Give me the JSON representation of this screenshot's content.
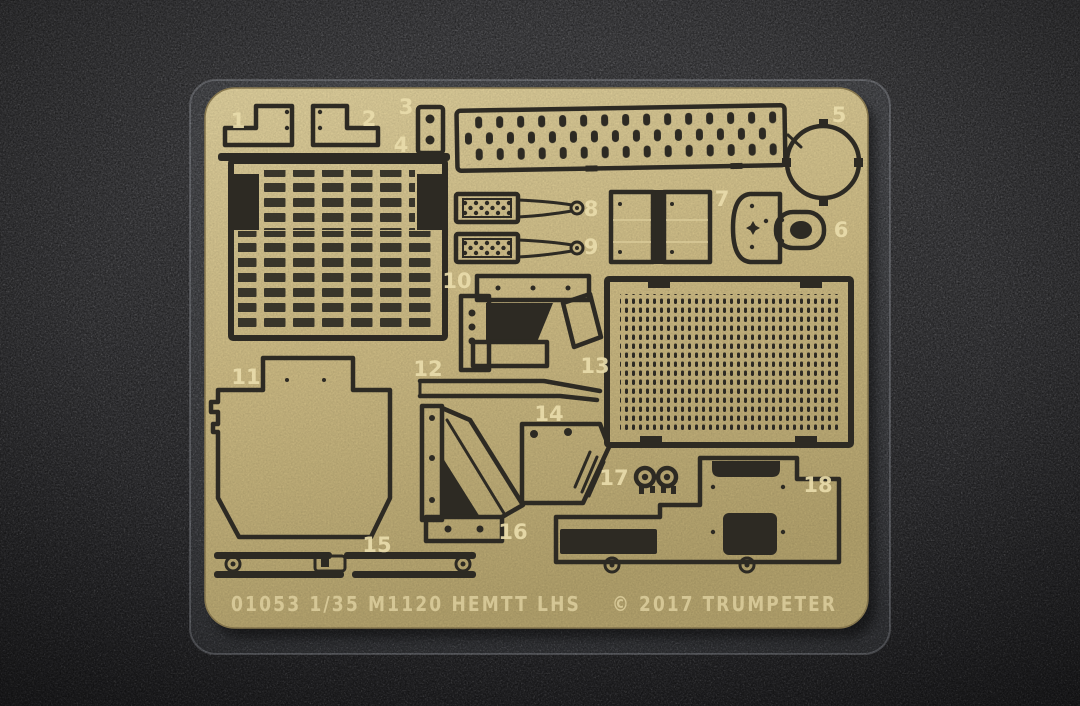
{
  "scene": {
    "subject": "photo-etched brass detail fret on dark carpet",
    "colors": {
      "carpet_base": "#3f3f42",
      "carpet_light": "#4b4b4e",
      "carpet_dark": "#29292c",
      "sleeve_edge": "#c9ced8",
      "brass": "#cbb983",
      "brass_light": "#dccd9b",
      "brass_dark": "#b2a16c",
      "etch_dark": "#2d2a23",
      "etched_text": "#e9dcab",
      "footer_text": "#ddcf9e"
    }
  },
  "fret": {
    "part_numbers": [
      "1",
      "2",
      "3",
      "4",
      "5",
      "6",
      "7",
      "8",
      "9",
      "10",
      "11",
      "12",
      "13",
      "14",
      "15",
      "16",
      "17",
      "18"
    ],
    "part_count": 18,
    "footer_left": "01053  1/35  M1120  HEMTT  LHS",
    "footer_right": "© 2017  TRUMPETER",
    "item_number": "01053",
    "scale": "1/35",
    "model": "M1120 HEMTT LHS",
    "copyright_year": "2017",
    "brand": "TRUMPETER"
  }
}
